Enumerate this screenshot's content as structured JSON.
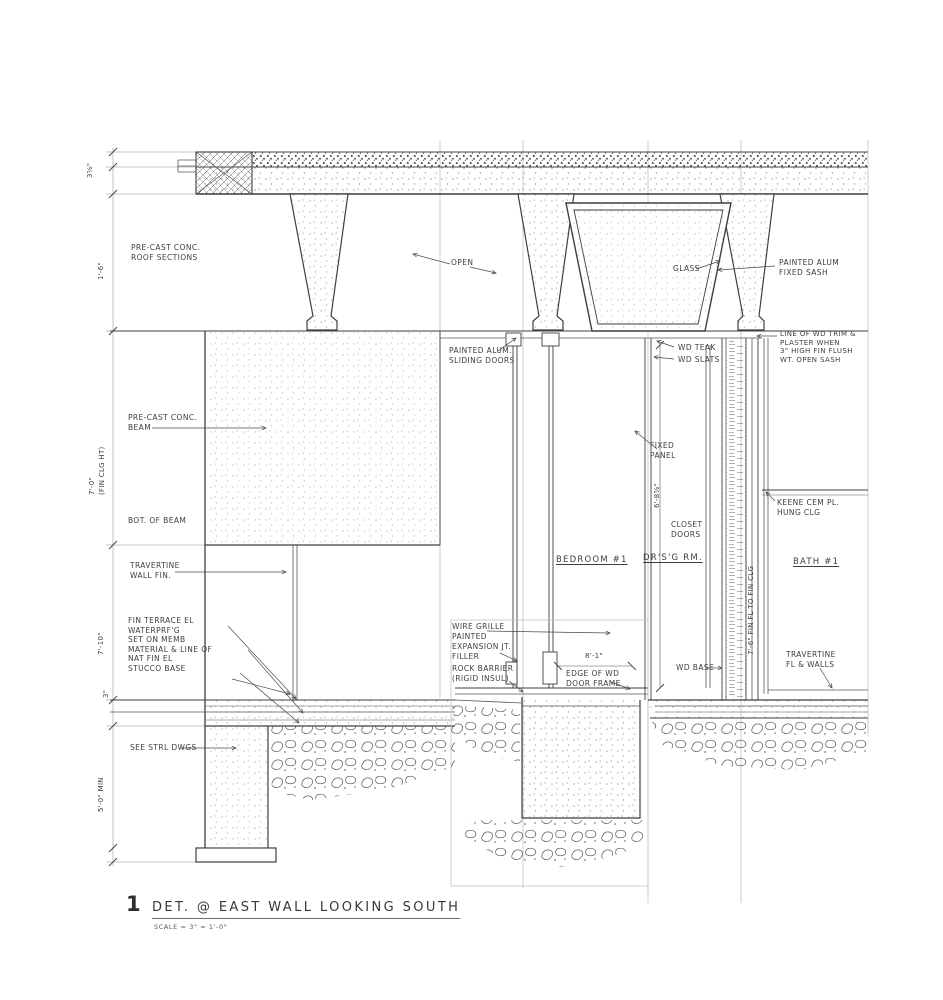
{
  "title": {
    "num": "1",
    "text": "DET. @ EAST WALL LOOKING SOUTH",
    "scale": "SCALE = 3\" = 1'-0\""
  },
  "labels": {
    "roof_sections": "PRE-CAST CONC.\nROOF SECTIONS",
    "beam": "PRE-CAST CONC.\nBEAM",
    "bot_of_beam": "BOT. OF BEAM",
    "travertine_wall": "TRAVERTINE\nWALL FIN.",
    "terrace_notes": "FIN TERRACE EL\nWATERPRF'G\nSET ON MEMB\nMATERIAL & LINE OF\nNAT FIN EL\nSTUCCO BASE",
    "see_strl": "SEE STRL DWGS",
    "open": "OPEN",
    "sliding_doors": "PAINTED ALUM.\nSLIDING DOORS",
    "glass": "GLASS",
    "fixed_sash": "PAINTED ALUM\nFIXED SASH",
    "wd_trim_note": "LINE OF WD TRIM &\nPLASTER WHEN\n3\" HIGH FIN FLUSH\nWT. OPEN SASH",
    "wd_teak": "WD TEAK",
    "wd_slats": "WD SLATS",
    "fixed_panel": "FIXED\nPANEL",
    "closet_doors": "CLOSET\nDOORS",
    "hung_clg": "KEENE CEM PL.\nHUNG CLG",
    "bedroom": "BEDROOM #1",
    "dressing": "DR'S'G RM.",
    "bath": "BATH #1",
    "wire_grille": "WIRE GRILLE\nPAINTED",
    "exp_jt": "EXPANSION JT.\nFILLER",
    "rock_barrier": "ROCK BARRIER\n(RIGID INSUL)",
    "edge_frame": "EDGE OF WD\nDOOR FRAME",
    "wd_base": "WD BASE",
    "travertine_fl": "TRAVERTINE\nFL & WALLS"
  },
  "dims": {
    "d36": "3⅝\"",
    "d16": "1'-6\"",
    "d70": "7'-0\"\n(FIN CLG HT)",
    "d710": "7'-10\"",
    "d3": "3\"",
    "d50": "5'-0\" MIN",
    "d685": "6'-8⅝\"",
    "d81": "8'-1\"",
    "d76": "7'-6\" FIN FL TO FIN CLG"
  },
  "colors": {
    "ink": "#3e3e3e",
    "paper": "#ffffff",
    "light_line": "#b8b8b8"
  }
}
